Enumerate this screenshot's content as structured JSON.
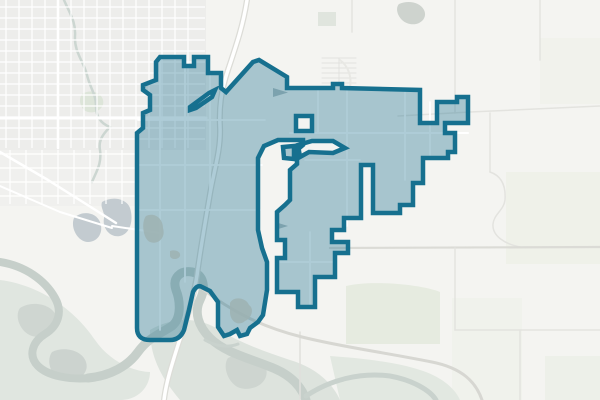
{
  "meta": {
    "width": 600,
    "height": 400,
    "kind": "web-map-viewport",
    "feature": "municipal-boundary-overlay"
  },
  "map": {
    "background": "#f4f4f1",
    "boundary": {
      "d": "M160,57 L184,57 L184,66 L194,66 L194,57 L208,57 L208,73 L221,73 L221,88 L226,92 L253,62 L259,60 L287,77 L287,88 L305,88 L333,88 L333,84 L342,84 L342,88 L420,90 L420,123 L437,123 L437,102 L457,102 L457,97 L468,97 L468,123 L445,123 L445,133 L455,133 L455,152 L448,152 L448,158 L423,158 L423,183 L413,183 L413,205 L400,205 L400,213 L373,213 L373,165 L361,165 L361,218 L344,218 L344,230 L332,230 L332,242 L348,242 L348,253 L335,253 L335,277 L315,277 L315,307 L298,307 L298,292 L277,292 L277,258 L285,258 L285,240 L277,240 L277,212 L285,205 L290,200 L290,170 L297,164 L297,150 L303,145 L303,140 L278,140 L264,146 L258,158 L258,230 L262,248 L267,262 L267,290 L263,315 L258,322 L250,328 L247,334 L240,336 L237,330 L230,334 L224,336 L218,327 L218,302 L210,291 L202,287 Q197,284 193,292 L189,310 L184,330 Q180,340 170,340 L150,340 Q137,340 137,328 L137,133 L143,128 L143,113 L150,110 L150,95 L143,90 L143,85 L156,80 L156,62 Z M190,107 L209,93 L215,90 L212,97 L196,108 L190,110 Z M296,116 L312,116 L312,131 L296,131 Z M283,147 L294,146 L294,159 L284,158 Z M298,145 L312,141 L333,141 L345,148 L333,153 L309,152 L300,157 Z",
      "fill": "rgba(22,110,141,0.35)",
      "stroke": "#16708f",
      "width": 4.5
    },
    "landuse": [
      {
        "d": "M0,0 h206 v150 h-206 Z",
        "fill": "#ededeb"
      },
      {
        "d": "M0,150 h140 v56 h-140 Z",
        "fill": "#f0f0ee"
      },
      {
        "d": "M82,94 C90,89 101,92 103,100 C105,108 96,114 88,112 C80,110 78,99 82,94 Z",
        "fill": "#dde5d9"
      },
      {
        "d": "M399,4 C408,0 420,2 424,10 C428,18 420,26 410,24 C399,22 394,9 399,4 Z",
        "fill": "#ced3ce"
      },
      {
        "d": "M318,12 h18 v14 h-18 Z",
        "fill": "#e0e5de"
      },
      {
        "d": "M506,172 h94 v92 h-94 Z",
        "fill": "#eff1e9"
      },
      {
        "d": "M540,38 h60 v66 h-60 Z",
        "fill": "#f1f2ec"
      },
      {
        "d": "M452,298 h70 v102 h-70 Z",
        "fill": "#f0f2ec"
      },
      {
        "d": "M346,286 C370,280 420,284 440,292 L440,344 L346,344 Z",
        "fill": "#e6ebe0"
      },
      {
        "d": "M545,356 h55 v44 h-55 Z",
        "fill": "#edf0e9"
      },
      {
        "d": "M0,280 C40,285 75,310 95,340 C110,362 135,372 150,372 C150,385 140,400 120,400 L0,400 Z",
        "fill": "#e0e6e0"
      },
      {
        "d": "M150,330 C170,318 196,316 216,328 C240,343 266,352 290,360 C310,366 330,378 340,400 L180,400 C163,380 150,358 150,330 Z",
        "fill": "#dde3dd"
      },
      {
        "d": "M330,356 C360,358 396,362 420,370 C440,376 455,388 460,400 L340,400 Z",
        "fill": "#e2e8e1"
      },
      {
        "d": "M20,308 C32,300 52,304 56,316 C60,330 46,340 32,336 C20,332 14,316 20,308 Z",
        "fill": "#cfd6d1"
      },
      {
        "d": "M52,352 C64,346 82,350 86,362 C90,374 76,384 62,380 C50,376 46,360 52,352 Z",
        "fill": "#ccd3cf"
      },
      {
        "d": "M228,358 C240,352 262,356 266,368 C270,382 254,392 240,388 C228,384 222,366 228,358 Z",
        "fill": "#ced5d0"
      }
    ],
    "lakes": [
      {
        "d": "M74,218 C82,210 96,212 100,222 C104,232 98,242 88,242 C78,242 70,228 74,218 Z",
        "fill": "#c3cbd0"
      },
      {
        "d": "M102,202 C112,196 126,198 130,208 C134,220 130,234 120,236 C110,238 102,228 104,218 C105,212 100,208 102,202 Z",
        "fill": "#c3cbd0"
      }
    ],
    "waterlines": [
      {
        "d": "M0,262 C25,266 45,280 55,298 C63,312 58,326 45,334 C32,342 28,356 38,366 C48,376 70,380 90,378",
        "stroke": "#c6cfca",
        "w": 8
      },
      {
        "d": "M88,378 C110,376 128,366 138,352 C148,338 160,334 172,326 C182,318 180,300 176,290 C172,278 180,270 192,272 C204,274 206,288 200,300 C194,312 198,326 210,338 C224,352 248,358 268,366 C285,372 300,382 306,400",
        "stroke": "#c6cfca",
        "w": 9
      },
      {
        "d": "M306,396 C330,380 360,372 390,376 C412,380 430,390 436,400",
        "stroke": "#c9d2cd",
        "w": 5
      },
      {
        "d": "M205,340 C215,346 228,348 238,344",
        "stroke": "#c9d2cd",
        "w": 3
      },
      {
        "d": "M64,0 C70,14 76,22 75,36 C74,52 84,62 87,75 C90,88 96,94 96,106 C96,118 102,124 110,127 C104,133 98,140 100,150 C102,164 96,172 92,182",
        "stroke": "#ccd6d1",
        "w": 2.5
      }
    ],
    "grids": [
      {
        "axis": "v",
        "from": 6,
        "to": 200,
        "step": 13,
        "start": 0,
        "end": 148,
        "stroke": "#ffffff",
        "w": 1.2
      },
      {
        "axis": "h",
        "from": 7,
        "to": 146,
        "step": 11,
        "start": 0,
        "end": 205,
        "stroke": "#ffffff",
        "w": 1.2
      },
      {
        "axis": "v",
        "from": 10,
        "to": 130,
        "step": 16,
        "start": 150,
        "end": 204,
        "stroke": "#ffffff",
        "w": 1.2
      },
      {
        "axis": "h",
        "from": 154,
        "to": 202,
        "step": 14,
        "start": 0,
        "end": 136,
        "stroke": "#ffffff",
        "w": 1.2
      }
    ],
    "roads": [
      {
        "d": "M0,118 L206,118",
        "stroke": "#ffffff",
        "w": 3
      },
      {
        "d": "M58,0 L58,148",
        "stroke": "#ffffff",
        "w": 2.5
      },
      {
        "d": "M0,152 L48,180 L116,223",
        "stroke": "#ffffff",
        "w": 2.5
      },
      {
        "d": "M0,186 L60,212 L112,228",
        "stroke": "#ffffff",
        "w": 2
      },
      {
        "d": "M112,226 L160,233",
        "stroke": "#ffffff",
        "w": 2
      },
      {
        "d": "M455,0 L455,113",
        "stroke": "#e3e3df",
        "w": 1.5
      },
      {
        "d": "M540,0 L540,60",
        "stroke": "#e3e3df",
        "w": 1.5
      },
      {
        "d": "M398,116 L470,112 L600,106",
        "stroke": "#e3e3df",
        "w": 1.5
      },
      {
        "d": "M490,113 L490,172",
        "stroke": "#e3e3df",
        "w": 1.5
      },
      {
        "d": "M490,172 C502,176 506,186 505,200 C504,210 494,214 493,224 C492,236 505,244 520,247",
        "stroke": "#e3e3df",
        "w": 1.5
      },
      {
        "d": "M330,248 L600,247",
        "stroke": "#dbdbd6",
        "w": 2.2
      },
      {
        "d": "M455,248 L455,330",
        "stroke": "#e3e3df",
        "w": 1.5
      },
      {
        "d": "M455,330 L600,330",
        "stroke": "#e3e3df",
        "w": 1.5
      },
      {
        "d": "M520,330 L520,400",
        "stroke": "#e3e3df",
        "w": 1.5
      },
      {
        "d": "M352,0 L352,32",
        "stroke": "#e3e3df",
        "w": 1.5
      },
      {
        "d": "M300,332 L300,400",
        "stroke": "#e0e0dc",
        "w": 1.5
      },
      {
        "d": "M322,58 h34",
        "stroke": "#e2e2de",
        "w": 1
      },
      {
        "d": "M322,63 h34",
        "stroke": "#e2e2de",
        "w": 1
      },
      {
        "d": "M322,68 h34",
        "stroke": "#e2e2de",
        "w": 1
      },
      {
        "d": "M322,73 h34",
        "stroke": "#e2e2de",
        "w": 1
      },
      {
        "d": "M322,78 h34",
        "stroke": "#e2e2de",
        "w": 1
      },
      {
        "d": "M322,83 h34",
        "stroke": "#e2e2de",
        "w": 1
      },
      {
        "d": "M339,58 v28",
        "stroke": "#e2e2de",
        "w": 1
      },
      {
        "d": "M340,60 C348,66 352,76 350,88",
        "stroke": "#e8e8e4",
        "w": 2
      },
      {
        "d": "M247,0 C243,26 236,46 228,70 C221,91 219,107 220,127 C221,150 214,170 210,194 C206,218 201,246 198,268 C196,286 189,314 179,342 C171,367 166,383 164,400",
        "stroke": "#dcdcd7",
        "w": 6
      },
      {
        "d": "M247,0 C243,26 236,46 228,70 C221,91 219,107 220,127 C221,150 214,170 210,194 C206,218 201,246 198,268 C196,286 189,314 179,342 C171,367 166,383 164,400",
        "stroke": "#ffffff",
        "w": 3.5
      },
      {
        "d": "M200,287 C232,312 262,327 302,337 C342,347 382,352 432,362 C462,368 476,382 482,400",
        "stroke": "#d7d7d2",
        "w": 3
      },
      {
        "d": "M138,120 L265,120",
        "stroke": "#ffffff",
        "w": 1.8
      },
      {
        "d": "M138,165 L262,165",
        "stroke": "#ffffff",
        "w": 1.8
      },
      {
        "d": "M138,210 L260,210",
        "stroke": "#ffffff",
        "w": 1.8
      },
      {
        "d": "M160,58 L160,330",
        "stroke": "#ffffff",
        "w": 1.8
      },
      {
        "d": "M185,58 L185,282",
        "stroke": "#ffffff",
        "w": 1.8
      },
      {
        "d": "M210,75 L210,195",
        "stroke": "#ffffff",
        "w": 1.8
      },
      {
        "d": "M290,133 L468,133",
        "stroke": "#ffffff",
        "w": 2
      },
      {
        "d": "M347,90 L347,226",
        "stroke": "#ffffff",
        "w": 1.8
      },
      {
        "d": "M318,90 L318,133",
        "stroke": "#ffffff",
        "w": 1.8
      },
      {
        "d": "M405,91 L405,180",
        "stroke": "#ffffff",
        "w": 1.8
      },
      {
        "d": "M430,102 L430,155",
        "stroke": "#ffffff",
        "w": 1.8
      },
      {
        "d": "M310,232 L310,305",
        "stroke": "#ffffff",
        "w": 1.8
      },
      {
        "d": "M280,262 L334,262",
        "stroke": "#ffffff",
        "w": 1.8
      },
      {
        "d": "M305,160 L360,160",
        "stroke": "#ffffff",
        "w": 1.8
      }
    ],
    "markers": [
      {
        "d": "M273,88 L288,92.5 L273,97 Z",
        "fill": "#b3bfc1"
      },
      {
        "d": "M275,222 L288,226 L275,230 Z",
        "fill": "#b3bfc1"
      }
    ],
    "ponds": [
      {
        "d": "M230,303 C233,296 246,297 249,305 C255,309 251,319 245,321 C238,327 230,321 230,312 Z",
        "fill": "#9db1b2"
      },
      {
        "d": "M146,216 C154,212 163,218 163,228 C166,238 158,245 150,242 C143,239 141,222 146,216 Z",
        "fill": "#9db1b2"
      },
      {
        "d": "M170,251 C176,249 181,252 180,256 C178,260 171,260 170,256 Z",
        "fill": "#9db1b2"
      }
    ]
  }
}
